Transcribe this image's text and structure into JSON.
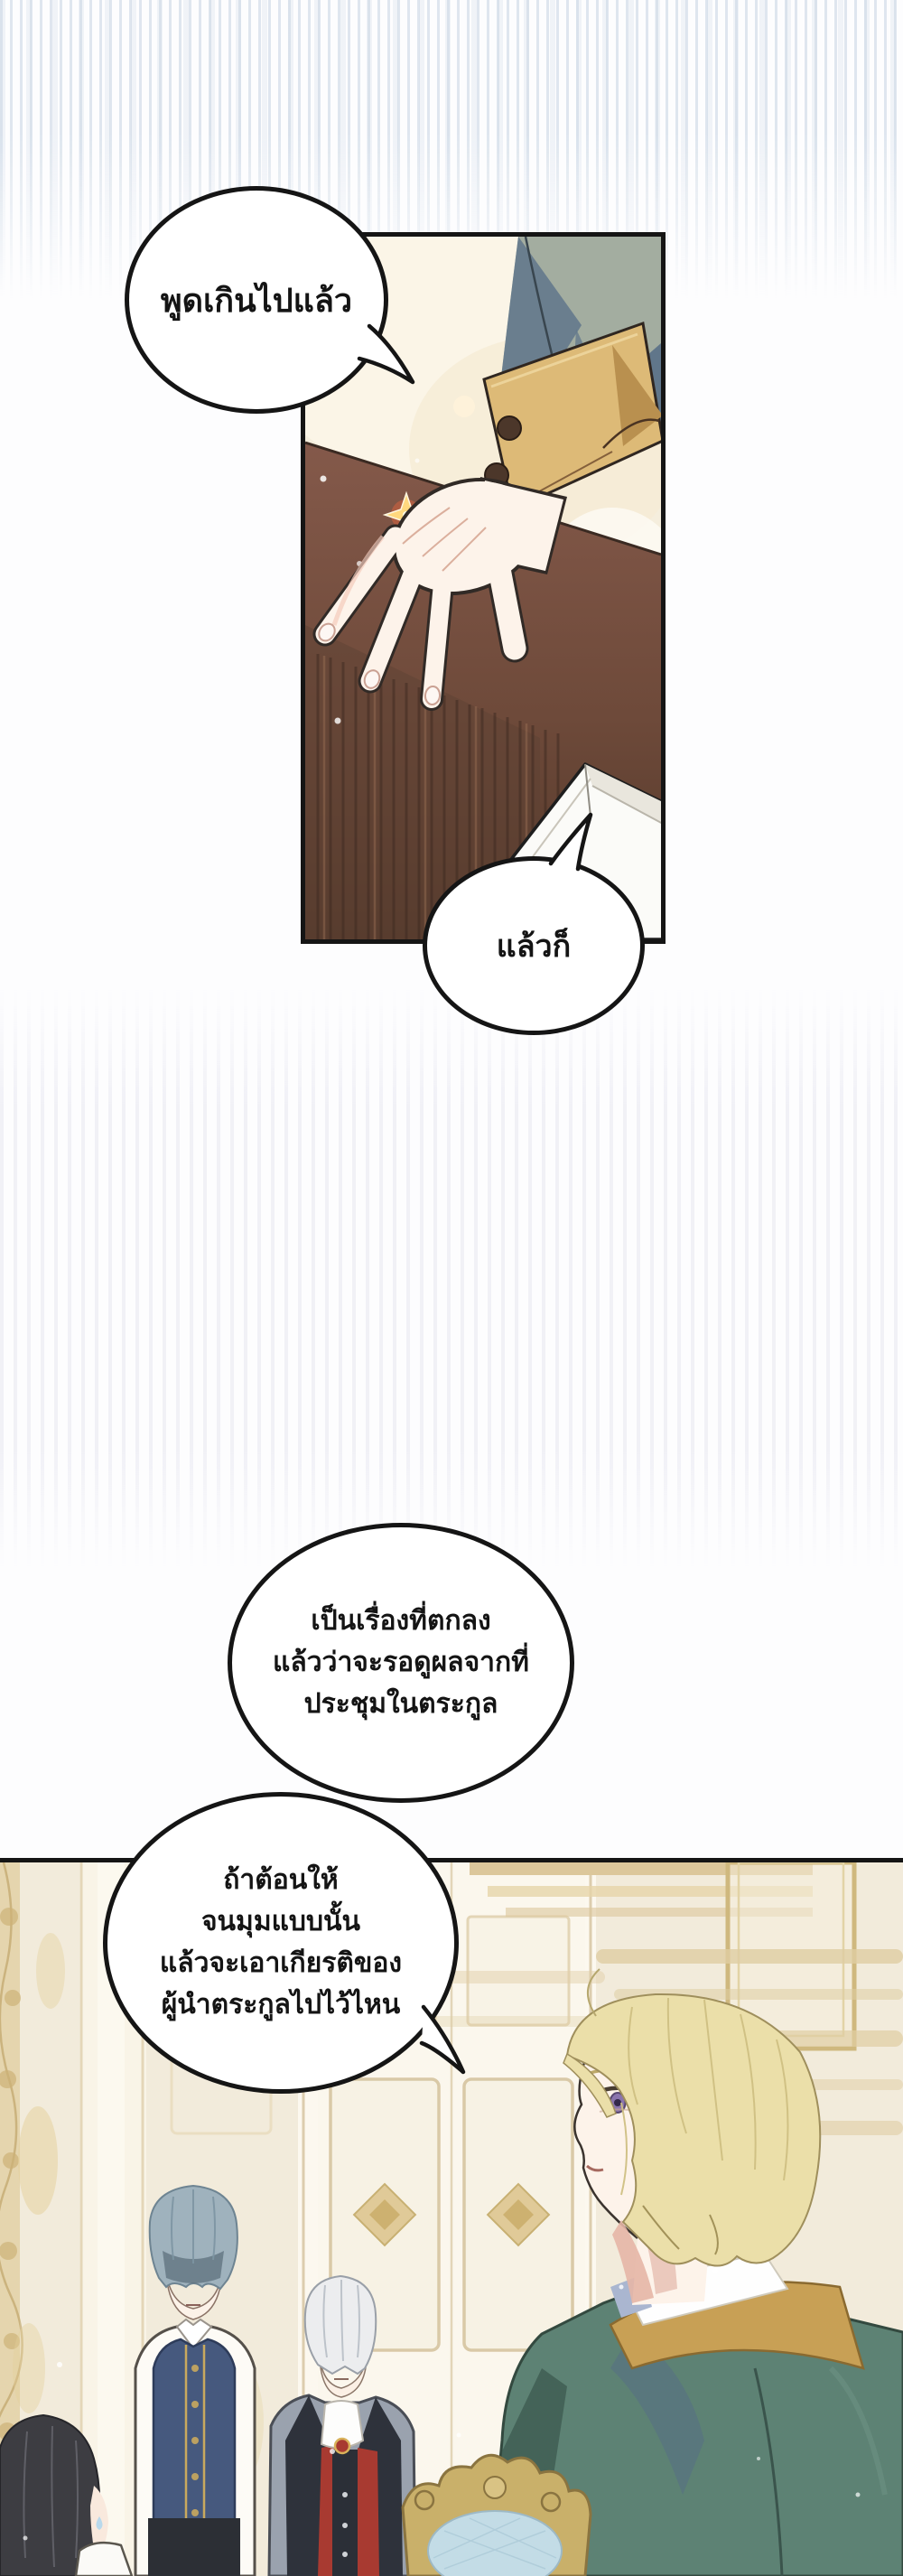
{
  "comic": {
    "bubbles": [
      {
        "name": "bubble-1",
        "text": "พูดเกินไปแล้ว"
      },
      {
        "name": "bubble-2",
        "text": "แล้วก็"
      },
      {
        "name": "bubble-3",
        "lines": [
          "เป็นเรื่องที่ตกลง",
          "แล้วว่าจะรอดูผลจากที่",
          "ประชุมในตระกูล"
        ]
      },
      {
        "name": "bubble-4",
        "lines": [
          "ถ้าต้อนให้",
          "จนมุมแบบนั้น",
          "แล้วจะเอาเกียรติของ",
          "ผู้นำตระกูลไปไว้ไหน"
        ]
      }
    ],
    "panels": [
      {
        "name": "panel-hand-on-desk",
        "elements": [
          "sleeve",
          "gold-cuff",
          "hand",
          "wooden-desk",
          "paper-stack",
          "sparkle"
        ]
      },
      {
        "name": "panel-palace-hall",
        "elements": [
          "ornate-door",
          "blonde-man-green-coat",
          "silver-hair-man",
          "blue-hair-boy",
          "black-hair-child",
          "ornate-chair"
        ]
      }
    ]
  },
  "colors": {
    "ink": "#151515",
    "wall_cream": "#f5eedd",
    "desk_brown": "#7d5444",
    "desk_dark": "#553a2d",
    "cuff_gold": "#ddba77",
    "sleeve_sage": "#a3ada0",
    "sleeve_shadow": "#5d7389",
    "skin": "#fdf3ea",
    "coat_teal": "#5d8274",
    "collar_gold": "#c8a055",
    "hair_blonde": "#ebdfa9",
    "hair_silver": "#ecedef",
    "hair_blue_gray": "#9fb2bd",
    "hair_black": "#3d3d42",
    "vest_navy": "#46597e",
    "vest_red": "#a83a31",
    "chair_gold": "#c9b06a",
    "chair_blue": "#c3dce6",
    "door_white": "#fcf8ef",
    "trim_gold": "#dcc48b",
    "stripe_blue": "#c7d4e2",
    "sparkle_orange": "#e8653c"
  }
}
